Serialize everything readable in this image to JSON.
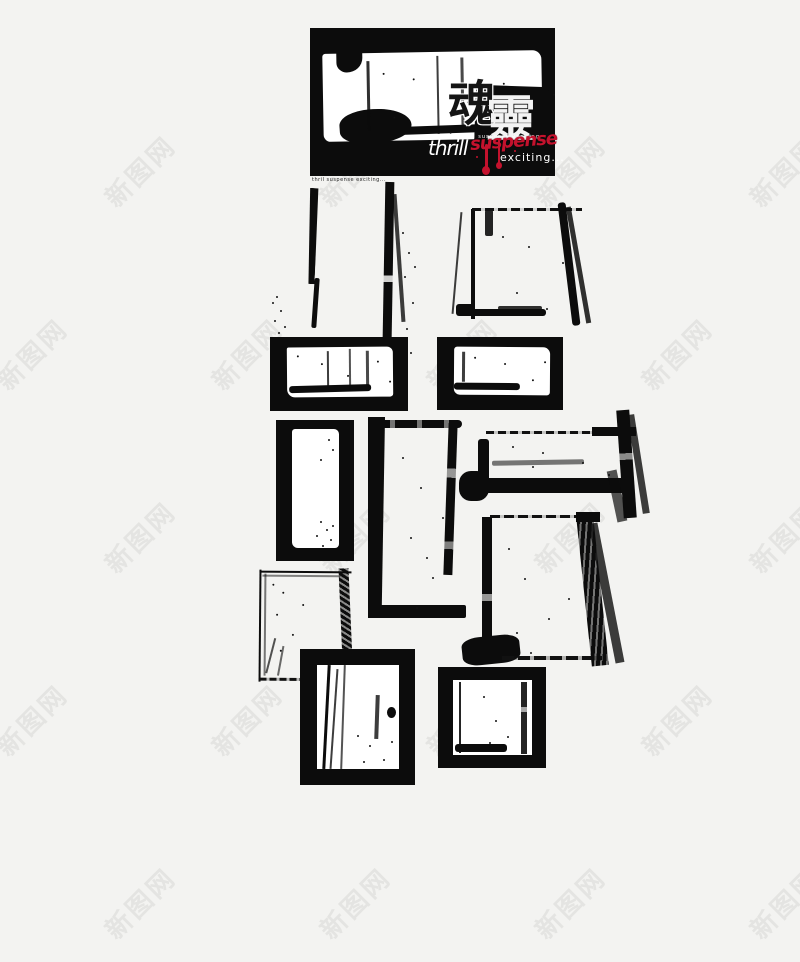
{
  "page": {
    "background": "#f3f3f1",
    "ink_color": "#0c0c0c",
    "accent_red": "#c4122d"
  },
  "watermark": {
    "text": "新图网",
    "color": "#e0e0dd"
  },
  "banner": {
    "char1": "魂",
    "char2": "靈",
    "small_tagline": "thrill suspense exciting",
    "thrill_label": "thrill",
    "suspense_label": "suspense",
    "exciting_label": "exciting..."
  },
  "caption": {
    "text": "thril suspense exciting..."
  }
}
